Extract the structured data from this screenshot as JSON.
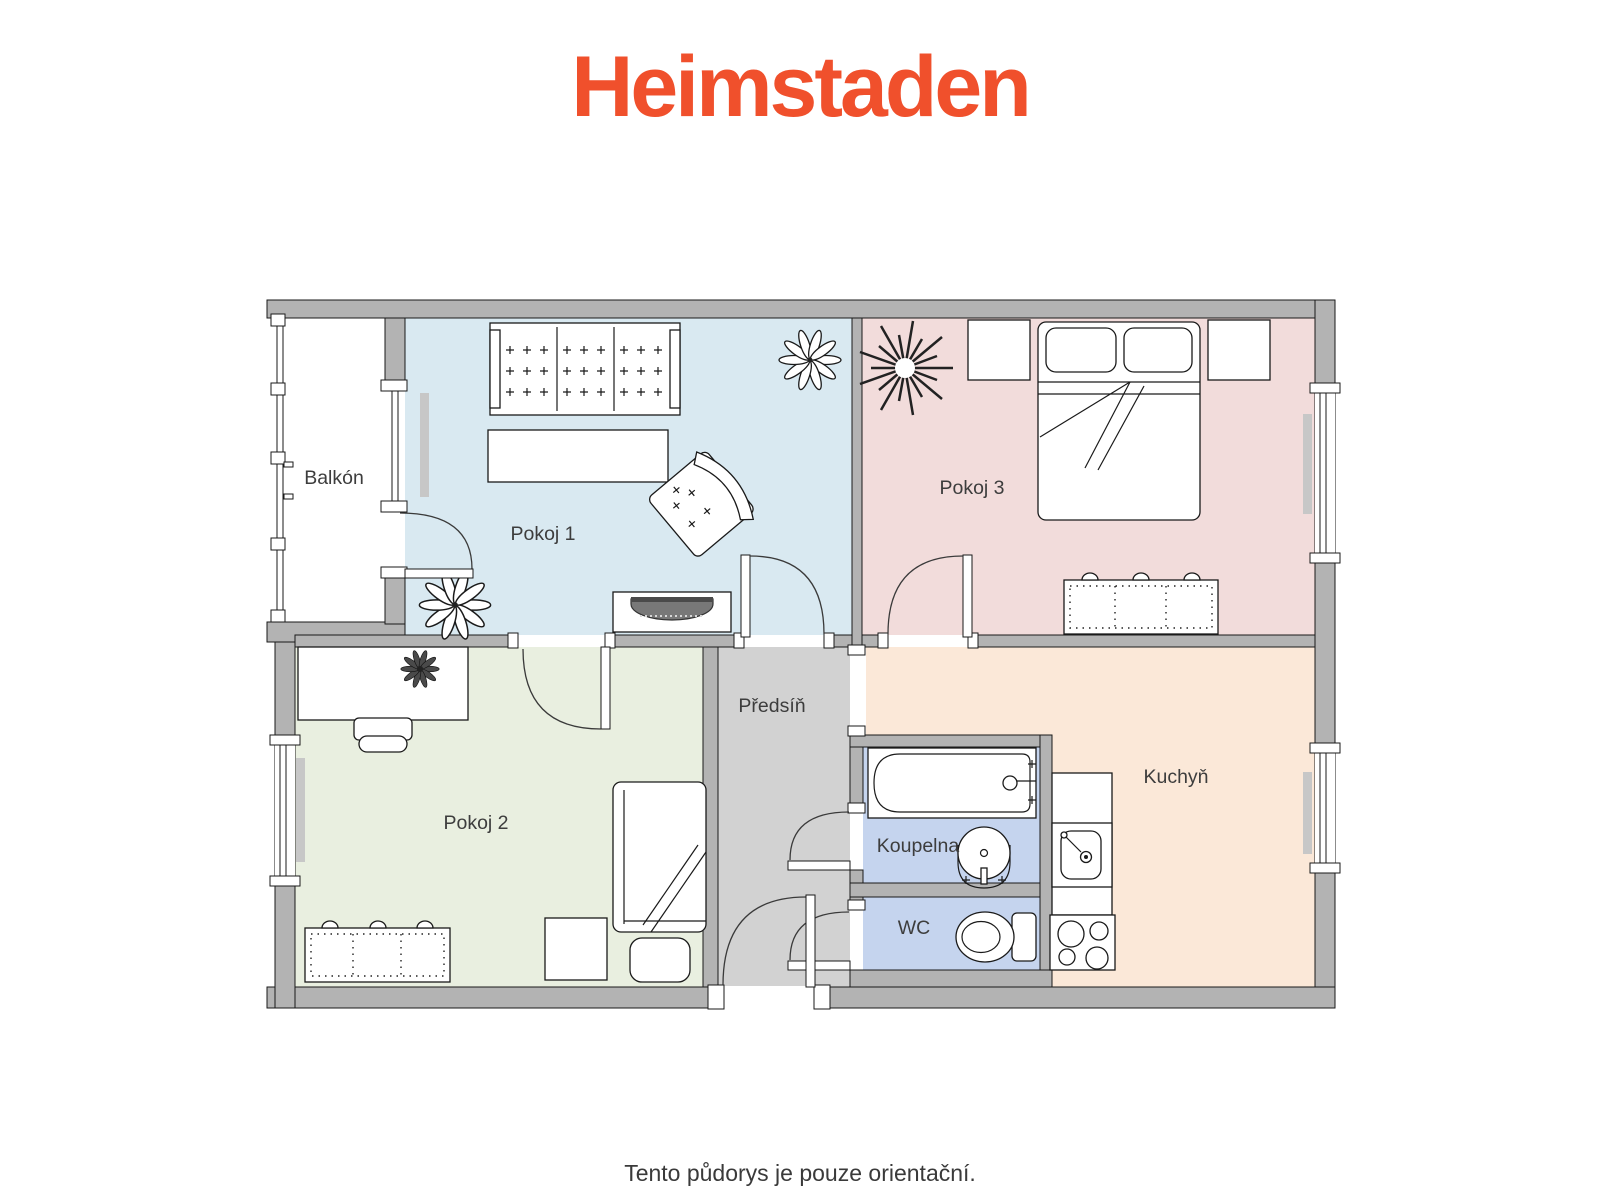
{
  "brand": {
    "name": "Heimstaden",
    "color": "#F0502C"
  },
  "footer": {
    "disclaimer": "Tento půdorys je pouze orientační."
  },
  "rooms": {
    "balcony": {
      "label": "Balkón",
      "floor_color": "#FFFFFF"
    },
    "pokoj1": {
      "label": "Pokoj 1",
      "floor_color": "#D9E9F1"
    },
    "pokoj3": {
      "label": "Pokoj 3",
      "floor_color": "#F2DCDB"
    },
    "pokoj2": {
      "label": "Pokoj 2",
      "floor_color": "#E9EFE0"
    },
    "predsin": {
      "label": "Předsíň",
      "floor_color": "#D2D2D2"
    },
    "koupelna": {
      "label": "Koupelna",
      "floor_color": "#C5D4EE"
    },
    "wc": {
      "label": "WC",
      "floor_color": "#C5D4EE"
    },
    "kuchyn": {
      "label": "Kuchyň",
      "floor_color": "#FBE8D8"
    }
  },
  "plan": {
    "wall_color": "#B3B3B3",
    "line_color": "#1a1a1a",
    "label_color": "#3d3d3d"
  }
}
